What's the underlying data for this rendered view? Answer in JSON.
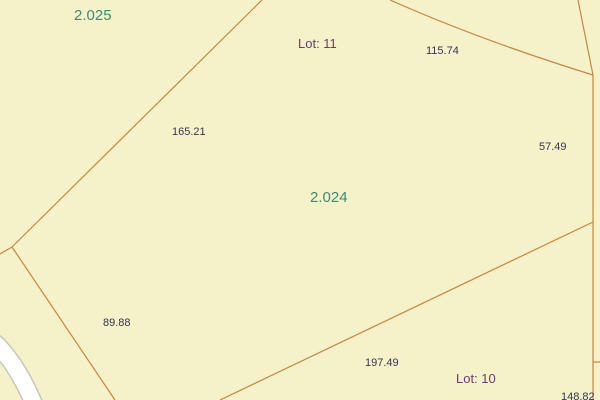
{
  "map": {
    "background_color": "#F5F2CA",
    "boundary_color": "#C9853E",
    "road": {
      "fill_color": "#FFFFFF",
      "border_color": "#C3C7B9"
    },
    "parcel_ids": [
      {
        "text": "2.025",
        "color": "#3E8B72"
      },
      {
        "text": "2.024",
        "color": "#3E8B72"
      }
    ],
    "lot_labels": [
      {
        "text": "Lot: 11",
        "color": "#6B3A7D"
      },
      {
        "text": "Lot: 10",
        "color": "#6B3A7D"
      }
    ],
    "measurements": [
      {
        "text": "165.21"
      },
      {
        "text": "115.74"
      },
      {
        "text": "57.49"
      },
      {
        "text": "89.88"
      },
      {
        "text": "197.49"
      },
      {
        "text": "148.82"
      }
    ],
    "measurement_color": "#34344E"
  }
}
